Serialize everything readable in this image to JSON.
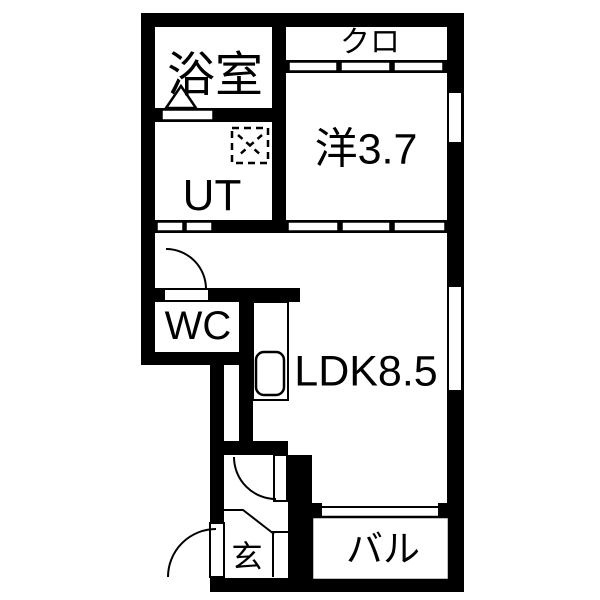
{
  "title": "apartment-floor-plan",
  "colors": {
    "wall": "#000000",
    "floor": "#ffffff",
    "line": "#000000"
  },
  "rooms": {
    "bathroom": {
      "label": "浴室"
    },
    "utility": {
      "label": "UT"
    },
    "closet": {
      "label": "クロ"
    },
    "western_room": {
      "label": "洋3.7"
    },
    "wc": {
      "label": "WC"
    },
    "ldk": {
      "label": "LDK8.5"
    },
    "entrance": {
      "label": "玄"
    },
    "balcony": {
      "label": "バル"
    }
  },
  "fixtures": [
    "washing-machine-pan-dashed-box",
    "kitchen-counter-with-sink",
    "bath-pictogram-triangle",
    "entrance-step-line",
    "shoe-cabinet"
  ],
  "openings": [
    "bathroom-sliding-door",
    "utility-two-panel-door",
    "closet-three-panel-slider",
    "western-room-three-panel-slider",
    "wc-swing-door",
    "ldk-hall-swing-door",
    "front-swing-door",
    "western-room-window",
    "ldk-window",
    "balcony-sliding-window"
  ]
}
